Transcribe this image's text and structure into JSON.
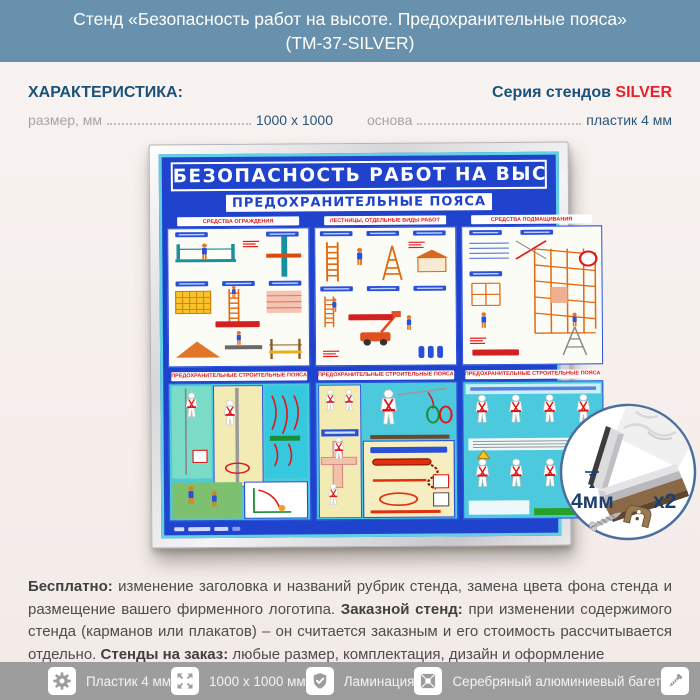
{
  "header": {
    "title_line1": "Стенд «Безопасность работ на высоте. Предохранительные пояса»",
    "title_line2": "(ТМ-37-SILVER)"
  },
  "characteristics": {
    "heading": "ХАРАКТЕРИСТИКА:",
    "series_label": "Серия стендов",
    "series_value": "SILVER",
    "specs": [
      {
        "label": "размер, мм",
        "value": "1000 x 1000"
      },
      {
        "label": "основа",
        "value": "пластик 4 мм"
      }
    ]
  },
  "poster": {
    "title": "БЕЗОПАСНОСТЬ РАБОТ НА ВЫСОТЕ",
    "subtitle": "ПРЕДОХРАНИТЕЛЬНЫЕ ПОЯСА",
    "panels_top": [
      "СРЕДСТВА ОГРАЖДЕНИЯ",
      "ЛЕСТНИЦЫ, ОТДЕЛЬНЫЕ ВИДЫ РАБОТ",
      "СРЕДСТВА ПОДМАЩИВАНИЯ"
    ],
    "panels_bottom": [
      "ПРЕДОХРАНИТЕЛЬНЫЕ СТРОИТЕЛЬНЫЕ ПОЯСА",
      "ПРЕДОХРАНИТЕЛЬНЫЕ СТРОИТЕЛЬНЫЕ ПОЯСА",
      "ПРЕДОХРАНИТЕЛЬНЫЕ СТРОИТЕЛЬНЫЕ ПОЯСА"
    ]
  },
  "detail_inset": {
    "thickness": "4мм",
    "quantity": "x2"
  },
  "description": {
    "segments": [
      {
        "text": "Бесплатно: "
      },
      {
        "text": "изменение заголовка и названий рубрик стенда, замена цвета фона стенда и размещение вашего фирменного логотипа. "
      },
      {
        "text": "Заказной стенд: "
      },
      {
        "text": "при изменении содержимого стенда (карманов или плакатов) – он считается заказным и его стоимость рассчитывается отдельно. "
      },
      {
        "text": "Стенды на заказ: "
      },
      {
        "text": "любые размер, комплектация, дизайн и оформление"
      }
    ]
  },
  "footer": {
    "items": [
      {
        "icon": "gear-icon",
        "label": "Пластик 4 мм"
      },
      {
        "icon": "expand-icon",
        "label": "1000 х 1000 мм"
      },
      {
        "icon": "shield-check-icon",
        "label": "Ламинация"
      },
      {
        "icon": "frame-icon",
        "label": "Серебряный алюминиевый багет"
      },
      {
        "icon": "screw-icon",
        "label": "Крепеж"
      }
    ]
  },
  "colors": {
    "header_bg": "#6891ad",
    "heading_blue": "#1b527b",
    "accent_red": "#e62129",
    "poster_blue": "#1f43cc",
    "poster_cyan": "#62cfe2",
    "footer_bg": "#9d9d9d"
  }
}
